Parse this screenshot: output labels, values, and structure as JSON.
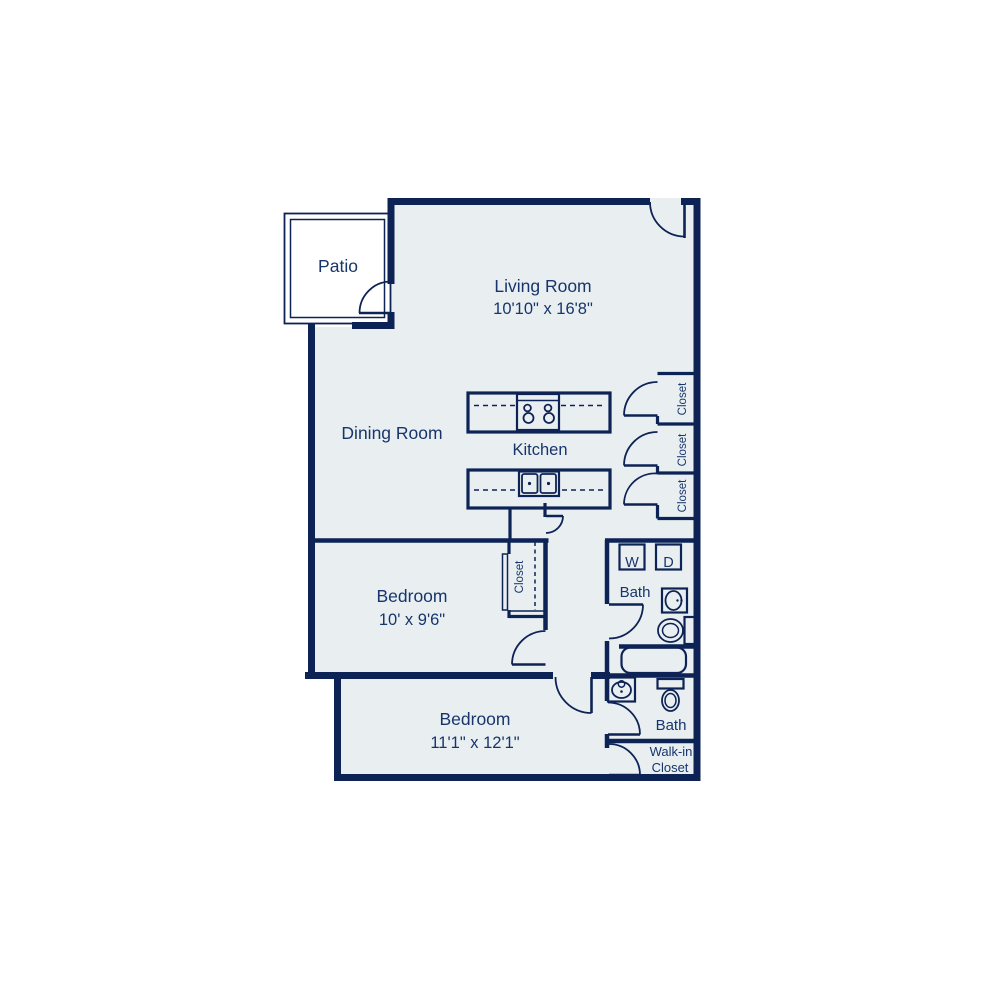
{
  "title": "Apartment floor plan",
  "colors": {
    "wall": "#0e2355",
    "floor_fill": "#e9eff1",
    "patio_fill": "#ffffff",
    "label_text": "#17356b",
    "background": "#ffffff"
  },
  "rooms": {
    "patio": {
      "label": "Patio"
    },
    "living_room": {
      "label": "Living Room",
      "dimensions": "10'10\" x 16'8\""
    },
    "dining_room": {
      "label": "Dining Room"
    },
    "kitchen": {
      "label": "Kitchen"
    },
    "bedroom_1": {
      "label": "Bedroom",
      "dimensions": "10' x 9'6\""
    },
    "bedroom_2": {
      "label": "Bedroom",
      "dimensions": "11'1\" x 12'1\""
    },
    "bath_1": {
      "label": "Bath"
    },
    "bath_2": {
      "label": "Bath"
    },
    "walk_in_closet": {
      "label_line1": "Walk-in",
      "label_line2": "Closet"
    },
    "closet_bank_top": {
      "label": "Closet"
    },
    "closet_bank_middle": {
      "label": "Closet"
    },
    "closet_bank_bottom": {
      "label": "Closet"
    },
    "bedroom_1_closet": {
      "label": "Closet"
    }
  },
  "appliances": {
    "washer": "W",
    "dryer": "D"
  },
  "icons": [
    "stove-icon",
    "double-sink-icon",
    "bathroom-sink-icon",
    "toilet-icon",
    "bathtub-icon",
    "washer-icon",
    "dryer-icon",
    "door-swing-arc"
  ]
}
